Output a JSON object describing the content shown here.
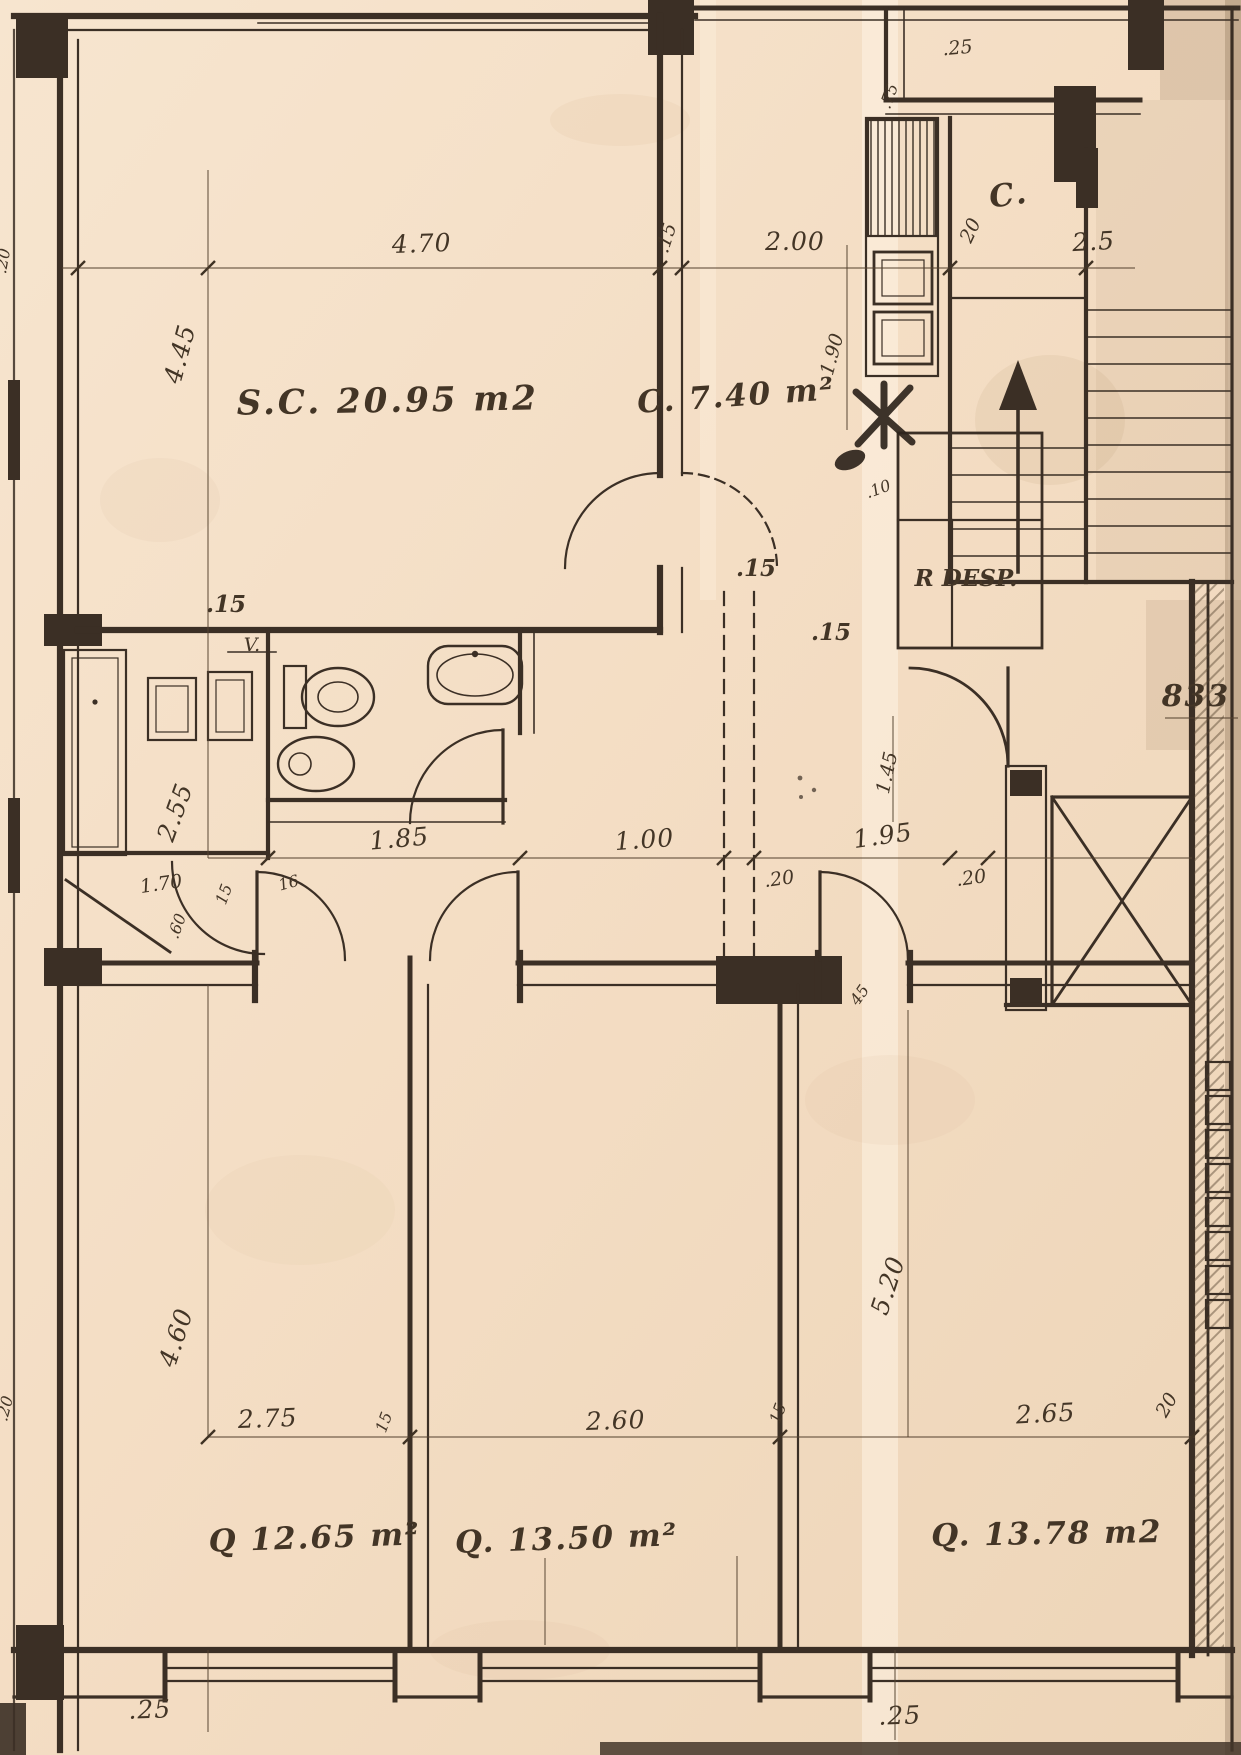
{
  "document": {
    "kind": "scanned architectural floor plan (apartment blueprint)",
    "paper_color": "#f3ddc5",
    "ink_color": "#3b2f25"
  },
  "labels": {
    "rooms": {
      "living": "S.C. 20.95 m2",
      "kitchen": "C. 7.40 m²",
      "pantry": "R DESP.",
      "stair_closet": "C.",
      "bedroom1": "Q 12.65 m²",
      "bedroom2": "Q. 13.50 m²",
      "bedroom3": "Q. 13.78 m2"
    },
    "annotations": {
      "vent": "V.",
      "street_number": "833"
    },
    "dims": {
      "top_470": "4.70",
      "top_15": ".15",
      "top_200": "2.00",
      "top_20": "20",
      "top_25": "2.5",
      "landing_25": ".25",
      "jut_75": ".75",
      "left_445": "4.45",
      "left_15": ".15",
      "left_255": "2.55",
      "left_170": "1.70",
      "left_15b": "15",
      "left_16": "16",
      "left_20_top": ".20",
      "left_20_bottom": ".20",
      "left_460": "4.60",
      "left_60": ".60",
      "mid_185": "1.85",
      "mid_100": "1.00",
      "mid_20a": ".20",
      "mid_195": "1.95",
      "mid_20b": ".20",
      "mid_15a": ".15",
      "mid_15b": ".15",
      "mid_10": ".10",
      "kitchen_190": "1.90",
      "mid_145": "1.45",
      "mid_45": "45",
      "right_520": "5.20",
      "right_20": "20",
      "bot_275": "2.75",
      "bot_15a": "15",
      "bot_260": "2.60",
      "bot_15b": "15",
      "bot_265": "2.65",
      "bot_25a": ".25",
      "bot_25b": ".25"
    }
  }
}
